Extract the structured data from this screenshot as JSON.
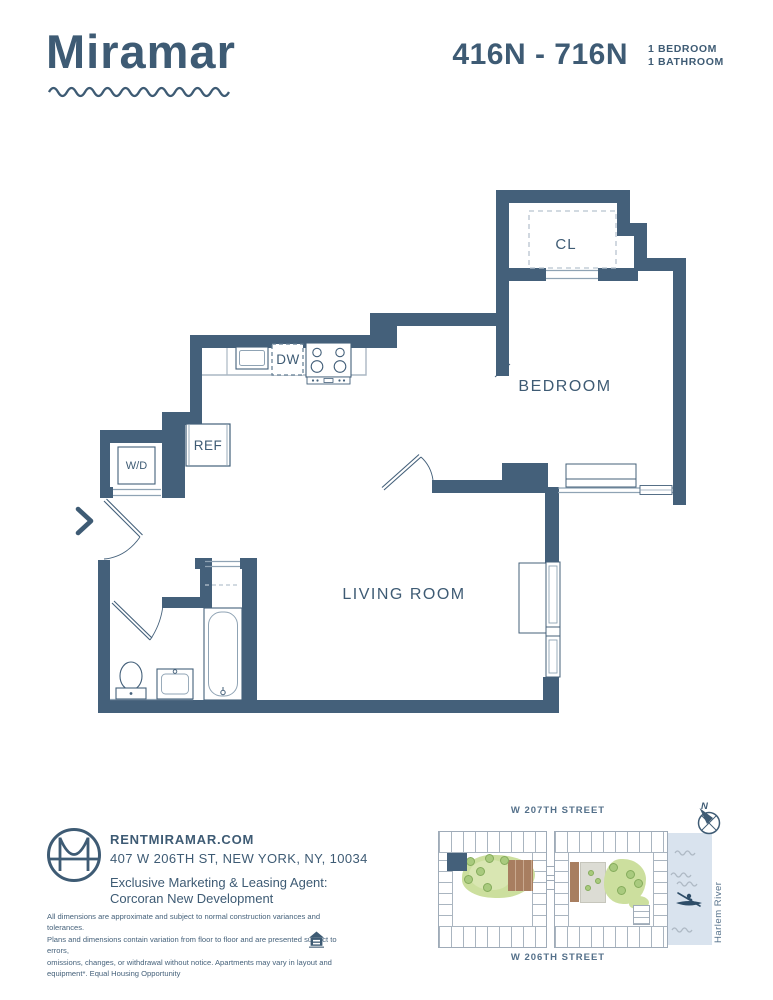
{
  "header": {
    "brand": "Miramar",
    "unit_range": "416N - 716N",
    "bed_line": "1 BEDROOM",
    "bath_line": "1 BATHROOM"
  },
  "floorplan": {
    "labels": {
      "closet": "CL",
      "dishwasher": "DW",
      "refrigerator": "REF",
      "washer_dryer": "W/D",
      "bedroom": "BEDROOM",
      "living_room": "LIVING ROOM"
    }
  },
  "footer": {
    "website": "RENTMIRAMAR.COM",
    "address": "407 W 206TH ST, NEW YORK, NY, 10034",
    "agent_line1": "Exclusive Marketing & Leasing Agent:",
    "agent_line2": "Corcoran New Development",
    "disclaimer_lines": [
      "All dimensions are approximate and subject to normal construction variances and tolerances.",
      "Plans and dimensions contain variation from floor to floor and are presented subject to errors,",
      "omissions, changes, or withdrawal without notice. Apartments may vary in layout and",
      "equipment*. Equal Housing Opportunity"
    ]
  },
  "sitemap": {
    "street_top": "W 207TH STREET",
    "street_bottom": "W 206TH STREET",
    "river_label": "Harlem River",
    "compass_n": "N"
  },
  "colors": {
    "wall": "#44607a",
    "text": "#3e5b74",
    "river": "#d9e3ee",
    "green": "#ccdf9e",
    "deck": "#a87e60"
  }
}
